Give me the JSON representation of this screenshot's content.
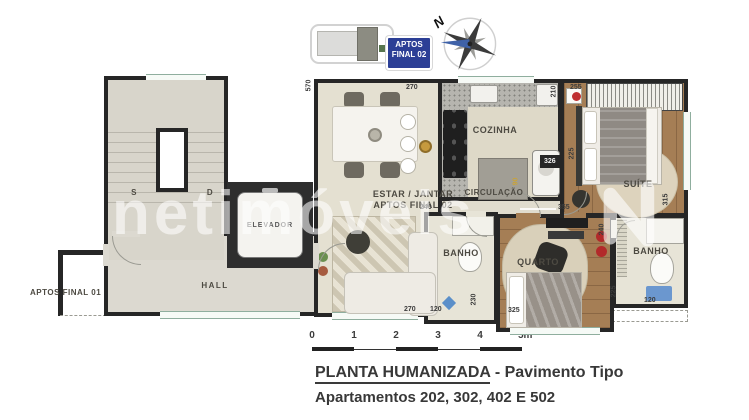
{
  "key_plan": {
    "badge_line1": "APTOS",
    "badge_line2": "FINAL 02"
  },
  "compass": {
    "north": "N"
  },
  "watermark": {
    "text": "netimóveis"
  },
  "plan": {
    "stair_up": "S",
    "stair_down": "D",
    "elevator": "ELEVADOR",
    "hall": "HALL",
    "aptos_final_01": "APTOS FINAL 01",
    "estar_line1": "ESTAR / JANTAR",
    "estar_line2": "APTOS FINAL 02",
    "cozinha": "COZINHA",
    "circulacao": "CIRCULAÇÃO",
    "banho_1": "BANHO",
    "quarto": "QUARTO",
    "suite": "SUÍTE",
    "banho_2": "BANHO"
  },
  "dimensions": [
    "570",
    "270",
    "210",
    "255",
    "326",
    "90",
    "355",
    "315",
    "225",
    "240",
    "270",
    "120",
    "230",
    "325",
    "240",
    "225",
    "120"
  ],
  "scale_bar": {
    "ticks": [
      "0",
      "1",
      "2",
      "3",
      "4",
      "5m"
    ]
  },
  "title": {
    "heading": "PLANTA HUMANIZADA",
    "heading_suffix": " - Pavimento Tipo",
    "subtitle": "Apartamentos 202, 302, 402 E 502"
  },
  "colors": {
    "badge_blue": "#2c3f96",
    "wall": "#262626",
    "wood_floor": "#a57e55",
    "compass_blue": "#3f62a8",
    "dim_yellow": "#c9a33a"
  }
}
